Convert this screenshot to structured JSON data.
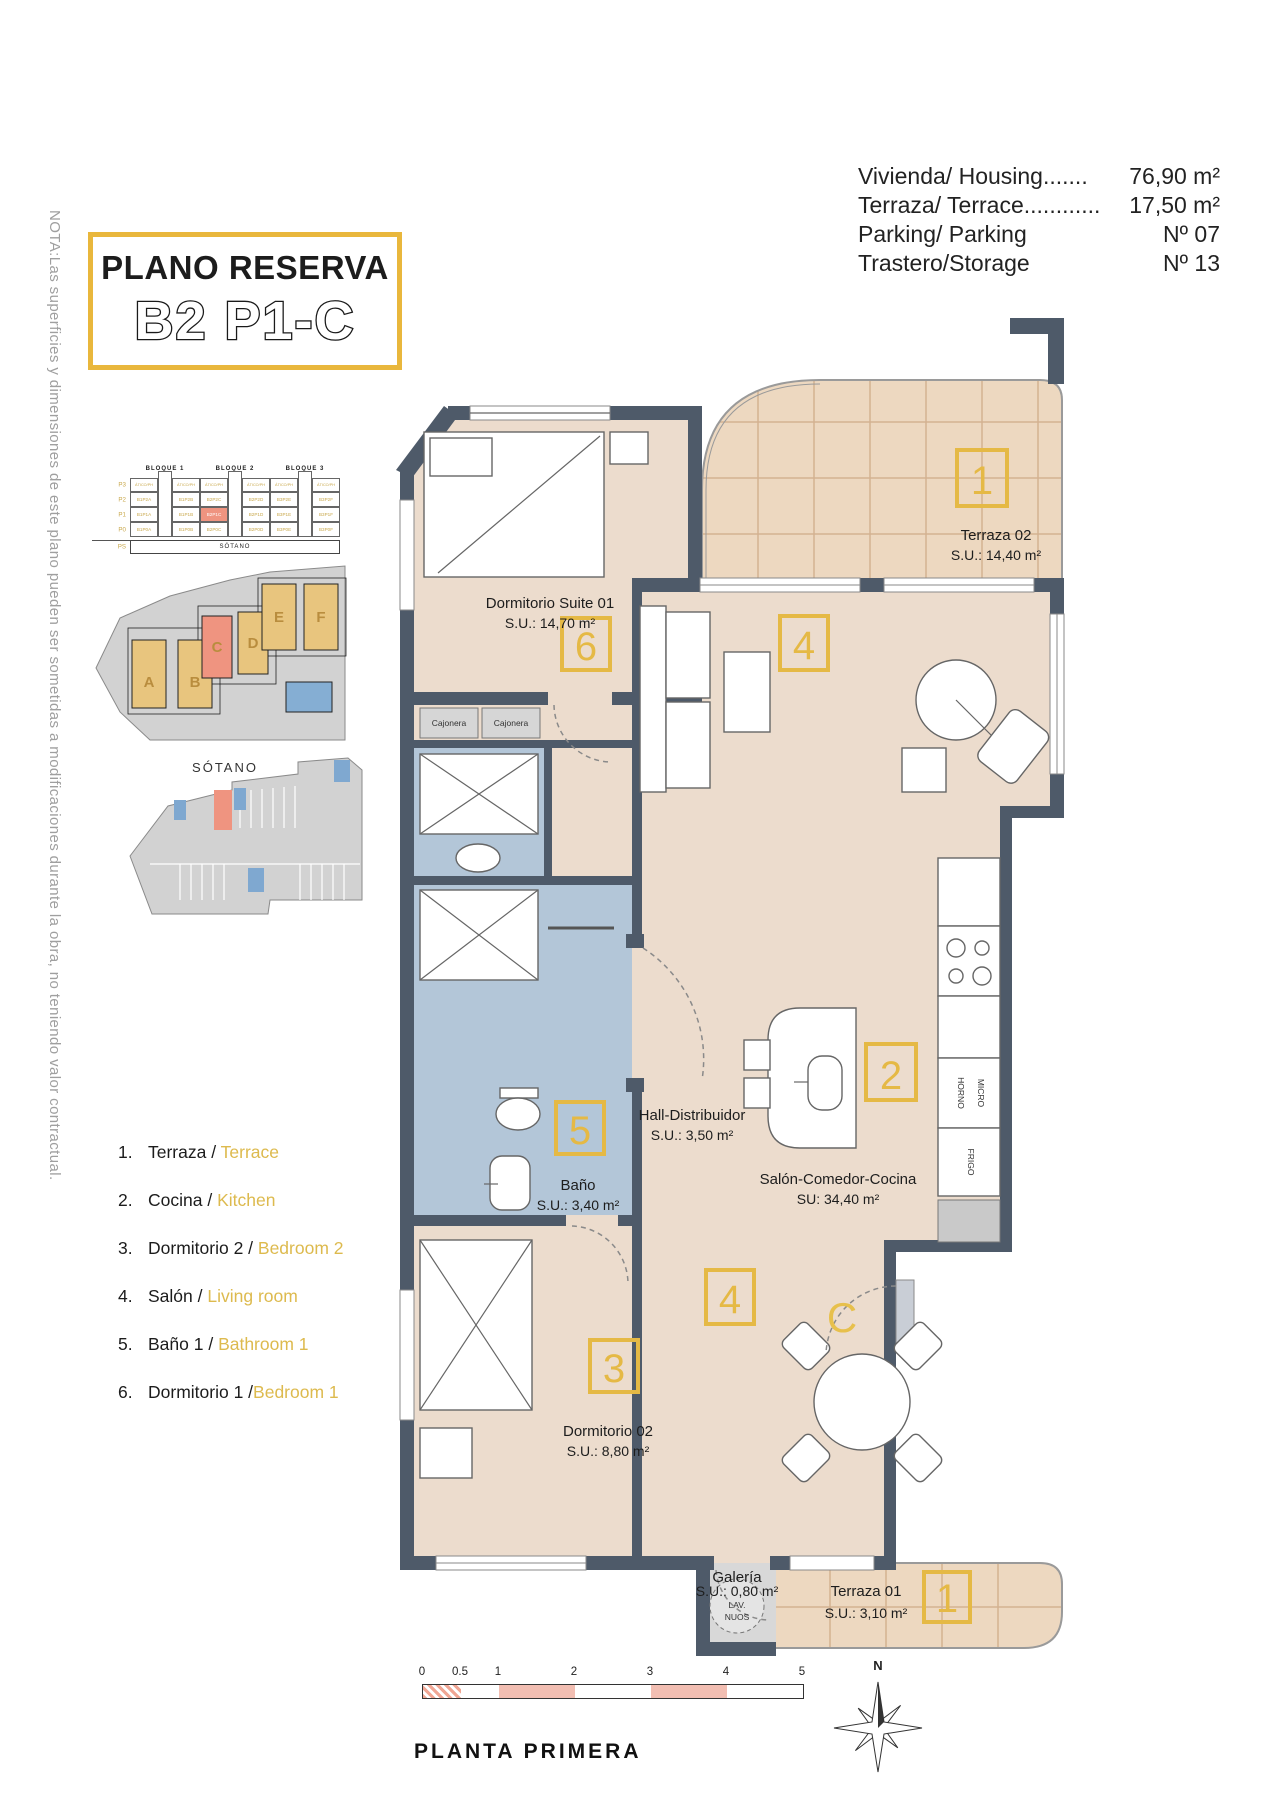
{
  "title": {
    "line1": "PLANO RESERVA",
    "line2": "B2 P1-C"
  },
  "note": "NOTA:Las superficies y dimensiones de este plano pueden ser sometidas a modificaciones durante la obra, no teniendo valor contractual.",
  "info": {
    "rows": [
      {
        "label": "Vivienda/ Housing",
        "dots": ".......",
        "value": "76,90 m²"
      },
      {
        "label": "Terraza/ Terrace",
        "dots": "............",
        "value": "17,50 m²"
      },
      {
        "label": "Parking/ Parking",
        "dots": "",
        "value": "Nº 07"
      },
      {
        "label": "Trastero/Storage",
        "dots": "",
        "value": "Nº 13"
      }
    ]
  },
  "keyplan": {
    "bloques": [
      "BLOQUE 1",
      "BLOQUE 2",
      "BLOQUE 3"
    ],
    "rows": [
      {
        "floor": "P3",
        "micro": true,
        "cells": [
          "ÁTICO/PH",
          "ÁTICO/PH",
          "ÁTICO/PH",
          "ÁTICO/PH",
          "ÁTICO/PH",
          "ÁTICO/PH"
        ]
      },
      {
        "floor": "P2",
        "cells": [
          "B1P2A",
          "B1P2B",
          "B2P2C",
          "B2P2D",
          "B3P2E",
          "B3P2F"
        ]
      },
      {
        "floor": "P1",
        "highlight": 2,
        "cells": [
          "B1P1A",
          "B1P1B",
          "B2P1C",
          "B2P1D",
          "B3P1E",
          "B3P1F"
        ]
      },
      {
        "floor": "P0",
        "cells": [
          "B1P0A",
          "B1P0B",
          "B2P0C",
          "B2P0D",
          "B3P0E",
          "B3P0F"
        ]
      }
    ],
    "sotano_floor": "PS",
    "sotano": "SÓTANO"
  },
  "siteplan": {
    "letters": [
      "A",
      "B",
      "C",
      "D",
      "E",
      "F"
    ]
  },
  "basement": {
    "label": "SÓTANO"
  },
  "legend": {
    "items": [
      {
        "num": "1.",
        "es": "Terraza",
        "sep": " / ",
        "en": "Terrace"
      },
      {
        "num": "2.",
        "es": "Cocina",
        "sep": " / ",
        "en": "Kitchen"
      },
      {
        "num": "3.",
        "es": "Dormitorio 2",
        "sep": " / ",
        "en": "Bedroom 2"
      },
      {
        "num": "4.",
        "es": "Salón",
        "sep": " / ",
        "en": "Living room"
      },
      {
        "num": "5.",
        "es": "Baño 1",
        "sep": " / ",
        "en": "Bathroom 1"
      },
      {
        "num": "6.",
        "es": "Dormitorio 1",
        "sep": " /",
        "en": "Bedroom 1"
      }
    ]
  },
  "plan": {
    "terraza02": {
      "badge": "1",
      "name": "Terraza 02",
      "area": "S.U.: 14,40 m²"
    },
    "suite": {
      "badge": "6",
      "name": "Dormitorio Suite 01",
      "area": "S.U.: 14,70 m²"
    },
    "cajonera": "Cajonera",
    "hall": {
      "name": "Hall-Distribuidor",
      "area": "S.U.: 3,50 m²"
    },
    "bano": {
      "badge": "5",
      "name": "Baño",
      "area": "S.U.: 3,40 m²"
    },
    "salon": {
      "name": "Salón-Comedor-Cocina",
      "area": "SU: 34,40 m²",
      "badge_living": "4",
      "badge_dining": "4",
      "badge_kitchen": "2"
    },
    "dorm2": {
      "badge": "3",
      "name": "Dormitorio 02",
      "area": "S.U.: 8,80 m²"
    },
    "galeria": {
      "name": "Galería",
      "area": "S.U.: 0,80 m²",
      "lav_line1": "LAV.",
      "lav_line2": "NUOS"
    },
    "terraza01": {
      "badge": "1",
      "name": "Terraza 01",
      "area": "S.U.: 3,10 m²"
    },
    "appliances": {
      "horno": "HORNO",
      "micro": "MICRO",
      "frigo": "FRIGO"
    },
    "entrance_letter": "C"
  },
  "scalebar": {
    "ticks": [
      "0",
      "0.5",
      "1",
      "2",
      "3",
      "4",
      "5"
    ]
  },
  "footer": {
    "caption": "PLANTA PRIMERA",
    "north": "N"
  }
}
